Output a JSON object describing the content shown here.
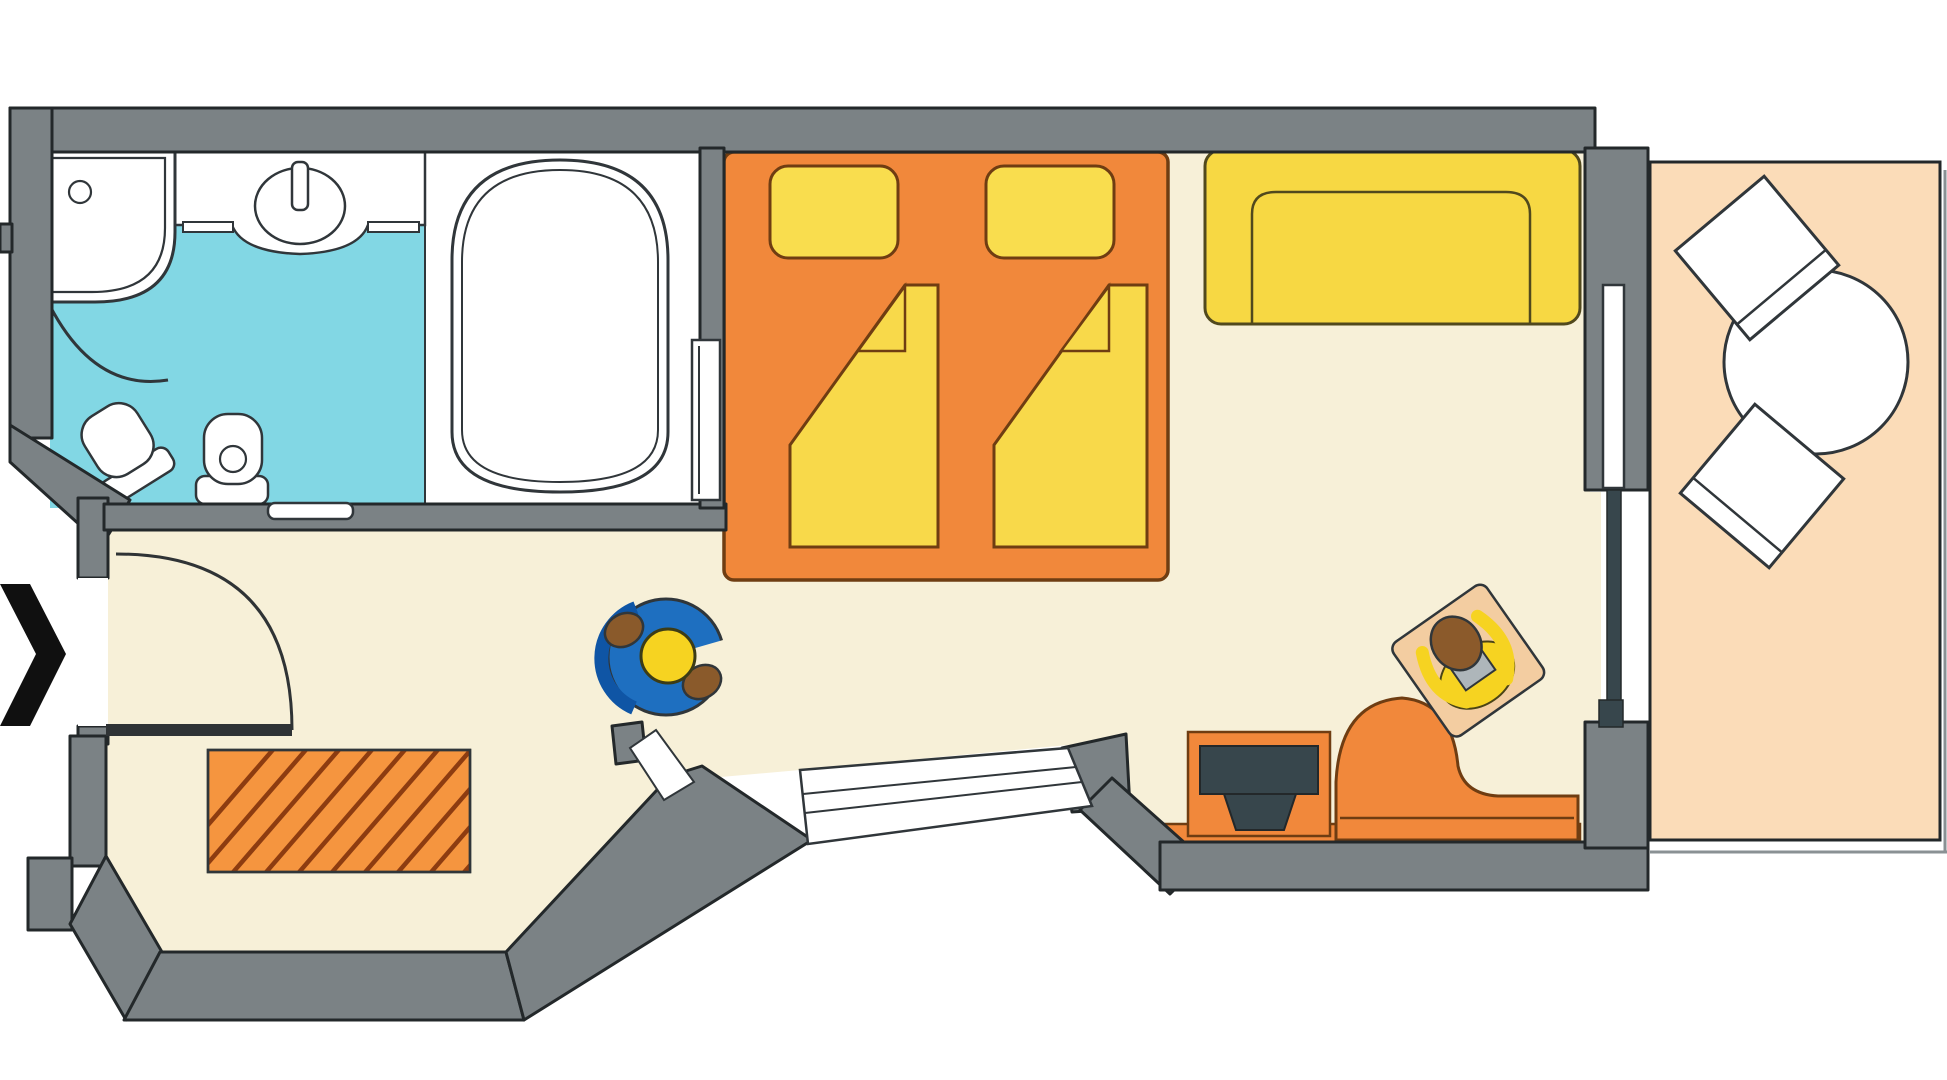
{
  "meta": {
    "title": "Hotel room floor plan (top-down architectural diagram)",
    "visible_text": "none",
    "view": "top-down 2D plan"
  },
  "palette": {
    "background": "#ffffff",
    "wall": "#7b8285",
    "wall_outline": "#23282a",
    "floor": "#f7f0d8",
    "bathroom_floor": "#82d7e4",
    "fixture_white": "#ffffff",
    "outline_dark": "#30363a",
    "orange": "#f1883b",
    "orange_outline": "#6f3d12",
    "rug_orange": "#f5953f",
    "rug_stripe": "#8d3c10",
    "yellow": "#f9dd4e",
    "blanket_yellow": "#f8d94a",
    "sofa_yellow": "#f7d843",
    "sofa_outline": "#51491d",
    "balcony_floor": "#fbdcb8",
    "balcony_edge_gray": "#8a9194",
    "tv_dark": "#37464c",
    "chair_blue": "#1e6fc0",
    "chair_blue_dark": "#0f55a5",
    "person_yellow": "#f6d321",
    "person_head_brown": "#8b5a2b",
    "armrest_brown": "#8a5a2b",
    "cushion_tan": "#f3cda1",
    "book_gray": "#aeb6ba",
    "door_leaf_dark": "#2f3335",
    "arrow_black": "#101010"
  },
  "rooms": [
    {
      "id": "bathroom",
      "label": "bathroom",
      "floor": "bathroom_floor"
    },
    {
      "id": "bathtub-room",
      "label": "bathtub area",
      "floor": "fixture_white"
    },
    {
      "id": "hallway",
      "label": "entrance hall",
      "floor": "floor"
    },
    {
      "id": "bay-window-alcove",
      "label": "bay window alcove",
      "floor": "floor"
    },
    {
      "id": "bedroom",
      "label": "bedroom / living area",
      "floor": "floor"
    },
    {
      "id": "tv-nook",
      "label": "tv lounge nook",
      "floor": "floor"
    },
    {
      "id": "balcony",
      "label": "balcony",
      "floor": "balcony_floor"
    }
  ],
  "fixtures": [
    "corner-shower with glass quarter-round door and swing arc",
    "vanity counter with oval washbasin and tap",
    "bathtub",
    "toilet with cistern",
    "bidet (angled against chamfered wall)",
    "wall shelf",
    "sliding bathroom door on bedroom wall",
    "entrance door with 90-degree swing arc",
    "double bed: orange frame, 2 yellow pillows, 2 folded yellow duvets",
    "yellow two-seat sofa against top wall",
    "blue swivel chair with seated person (yellow head, brown armrests)",
    "orange hatched rug in bay window alcove",
    "flat TV on orange sideboard",
    "orange chaise lounge with person reading a gray book on tan cushion",
    "balcony round table with two white chairs",
    "sliding balcony door (white + dark panels)",
    "angled picture window in bottom wall",
    "black entrance direction arrow outside left wall"
  ]
}
